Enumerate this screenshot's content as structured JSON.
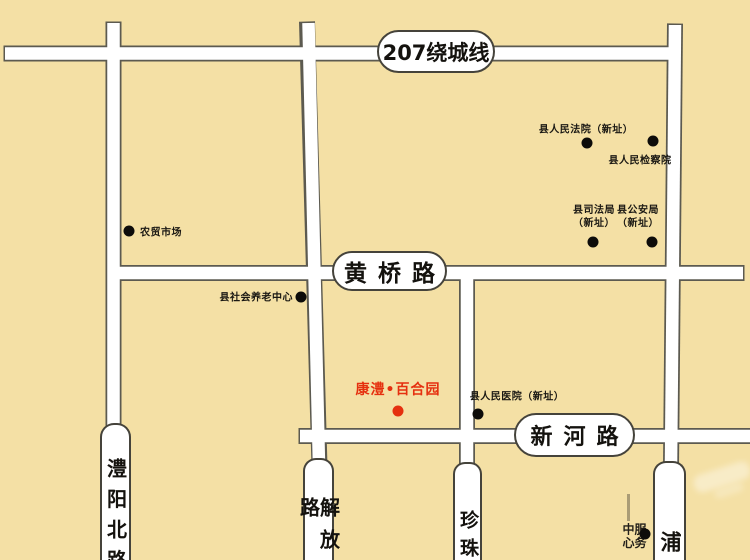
{
  "colors": {
    "background": "#F4E0A5",
    "road_fill": "#FFFFFF",
    "road_casing": "#5C5A50",
    "capsule_border": "#45433B",
    "text": "#17150F",
    "project_red": "#E5300F",
    "marker_black": "#0D0C0A"
  },
  "road_labels": {
    "ring": "207绕城线",
    "huangqiao": "黄桥路",
    "xinhe": "新河路",
    "liyang": "澧阳北路",
    "jiefang": "解放路",
    "zhenzhu": "珍珠",
    "pu": "浦"
  },
  "pois": {
    "court": {
      "label": "县人民法院（新址）"
    },
    "procuratorate": {
      "label": "县人民检察院"
    },
    "justice_bureau": {
      "line1": "县司法局",
      "line2": "（新址）"
    },
    "police_bureau": {
      "line1": "县公安局",
      "line2": "（新址）"
    },
    "farmers_market": {
      "label": "农贸市场"
    },
    "elderly_center": {
      "label": "县社会养老中心"
    },
    "hospital": {
      "label": "县人民医院（新址）"
    },
    "service_center": {
      "label": "服务中心"
    }
  },
  "project": {
    "label": "康澧•百合园"
  }
}
